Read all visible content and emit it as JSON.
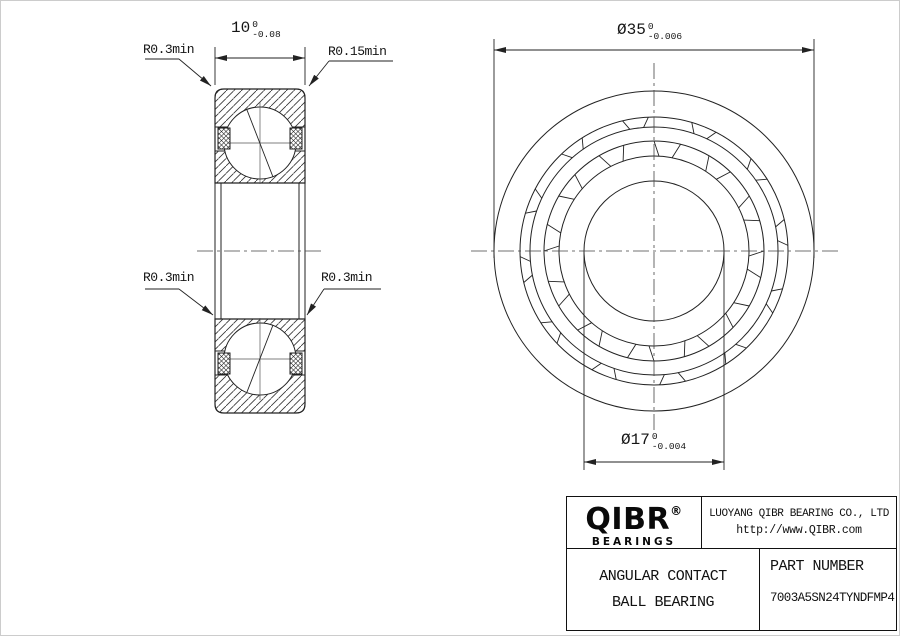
{
  "cross_section": {
    "width_dim": {
      "nominal": "10",
      "upper_tol": "0",
      "lower_tol": "-0.08"
    },
    "corner_labels": {
      "top_left": "R0.3min",
      "top_right": "R0.15min",
      "mid_left": "R0.3min",
      "mid_right": "R0.3min"
    }
  },
  "front_view": {
    "outer_diameter_dim": {
      "nominal": "Ø35",
      "upper_tol": "0",
      "lower_tol": "-0.006"
    },
    "bore_diameter_dim": {
      "nominal": "Ø17",
      "upper_tol": "0",
      "lower_tol": "-0.004"
    }
  },
  "title_block": {
    "logo_text": "QIBR",
    "logo_registered": "®",
    "logo_subtext": "BEARINGS",
    "company_name": "LUOYANG QIBR BEARING CO., LTD",
    "website": "http://www.QIBR.com",
    "product_line1": "ANGULAR CONTACT",
    "product_line2": "BALL BEARING",
    "part_number_label": "PART NUMBER",
    "part_number": "7003A5SN24TYNDFMP4"
  },
  "colors": {
    "line": "#222222",
    "text": "#111111",
    "background": "#ffffff"
  }
}
